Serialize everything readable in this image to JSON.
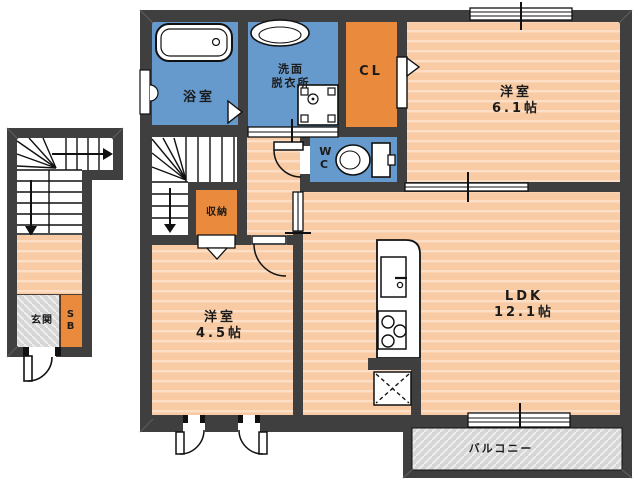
{
  "plan_title": "2F floor plan",
  "rooms": {
    "bathroom": {
      "label": "浴室"
    },
    "washroom": {
      "line1": "洗面",
      "line2": "脱衣所"
    },
    "closet": {
      "label": "CL"
    },
    "bedroom_east": {
      "label": "洋室",
      "size": "6.1帖"
    },
    "toilet": {
      "label": "WC"
    },
    "storage": {
      "label": "収納"
    },
    "bedroom_west": {
      "label": "洋室",
      "size": "4.5帖"
    },
    "ldk": {
      "label": "LDK",
      "size": "12.1帖"
    },
    "entrance": {
      "label": "玄関"
    },
    "shoe_box": {
      "label": "SB"
    },
    "balcony": {
      "label": "バルコニー"
    }
  },
  "colors": {
    "wall": "#3f3f3f",
    "wet_area_blue": "#6699cc",
    "closet_orange": "#e98a3c",
    "floor_peach": "#f8cba4",
    "floor_stripe": "#fcdfc6",
    "hatch_gray": "#d6d6d6",
    "hatch_stripe": "#efefef",
    "linework": "#111111",
    "background": "#ffffff"
  }
}
